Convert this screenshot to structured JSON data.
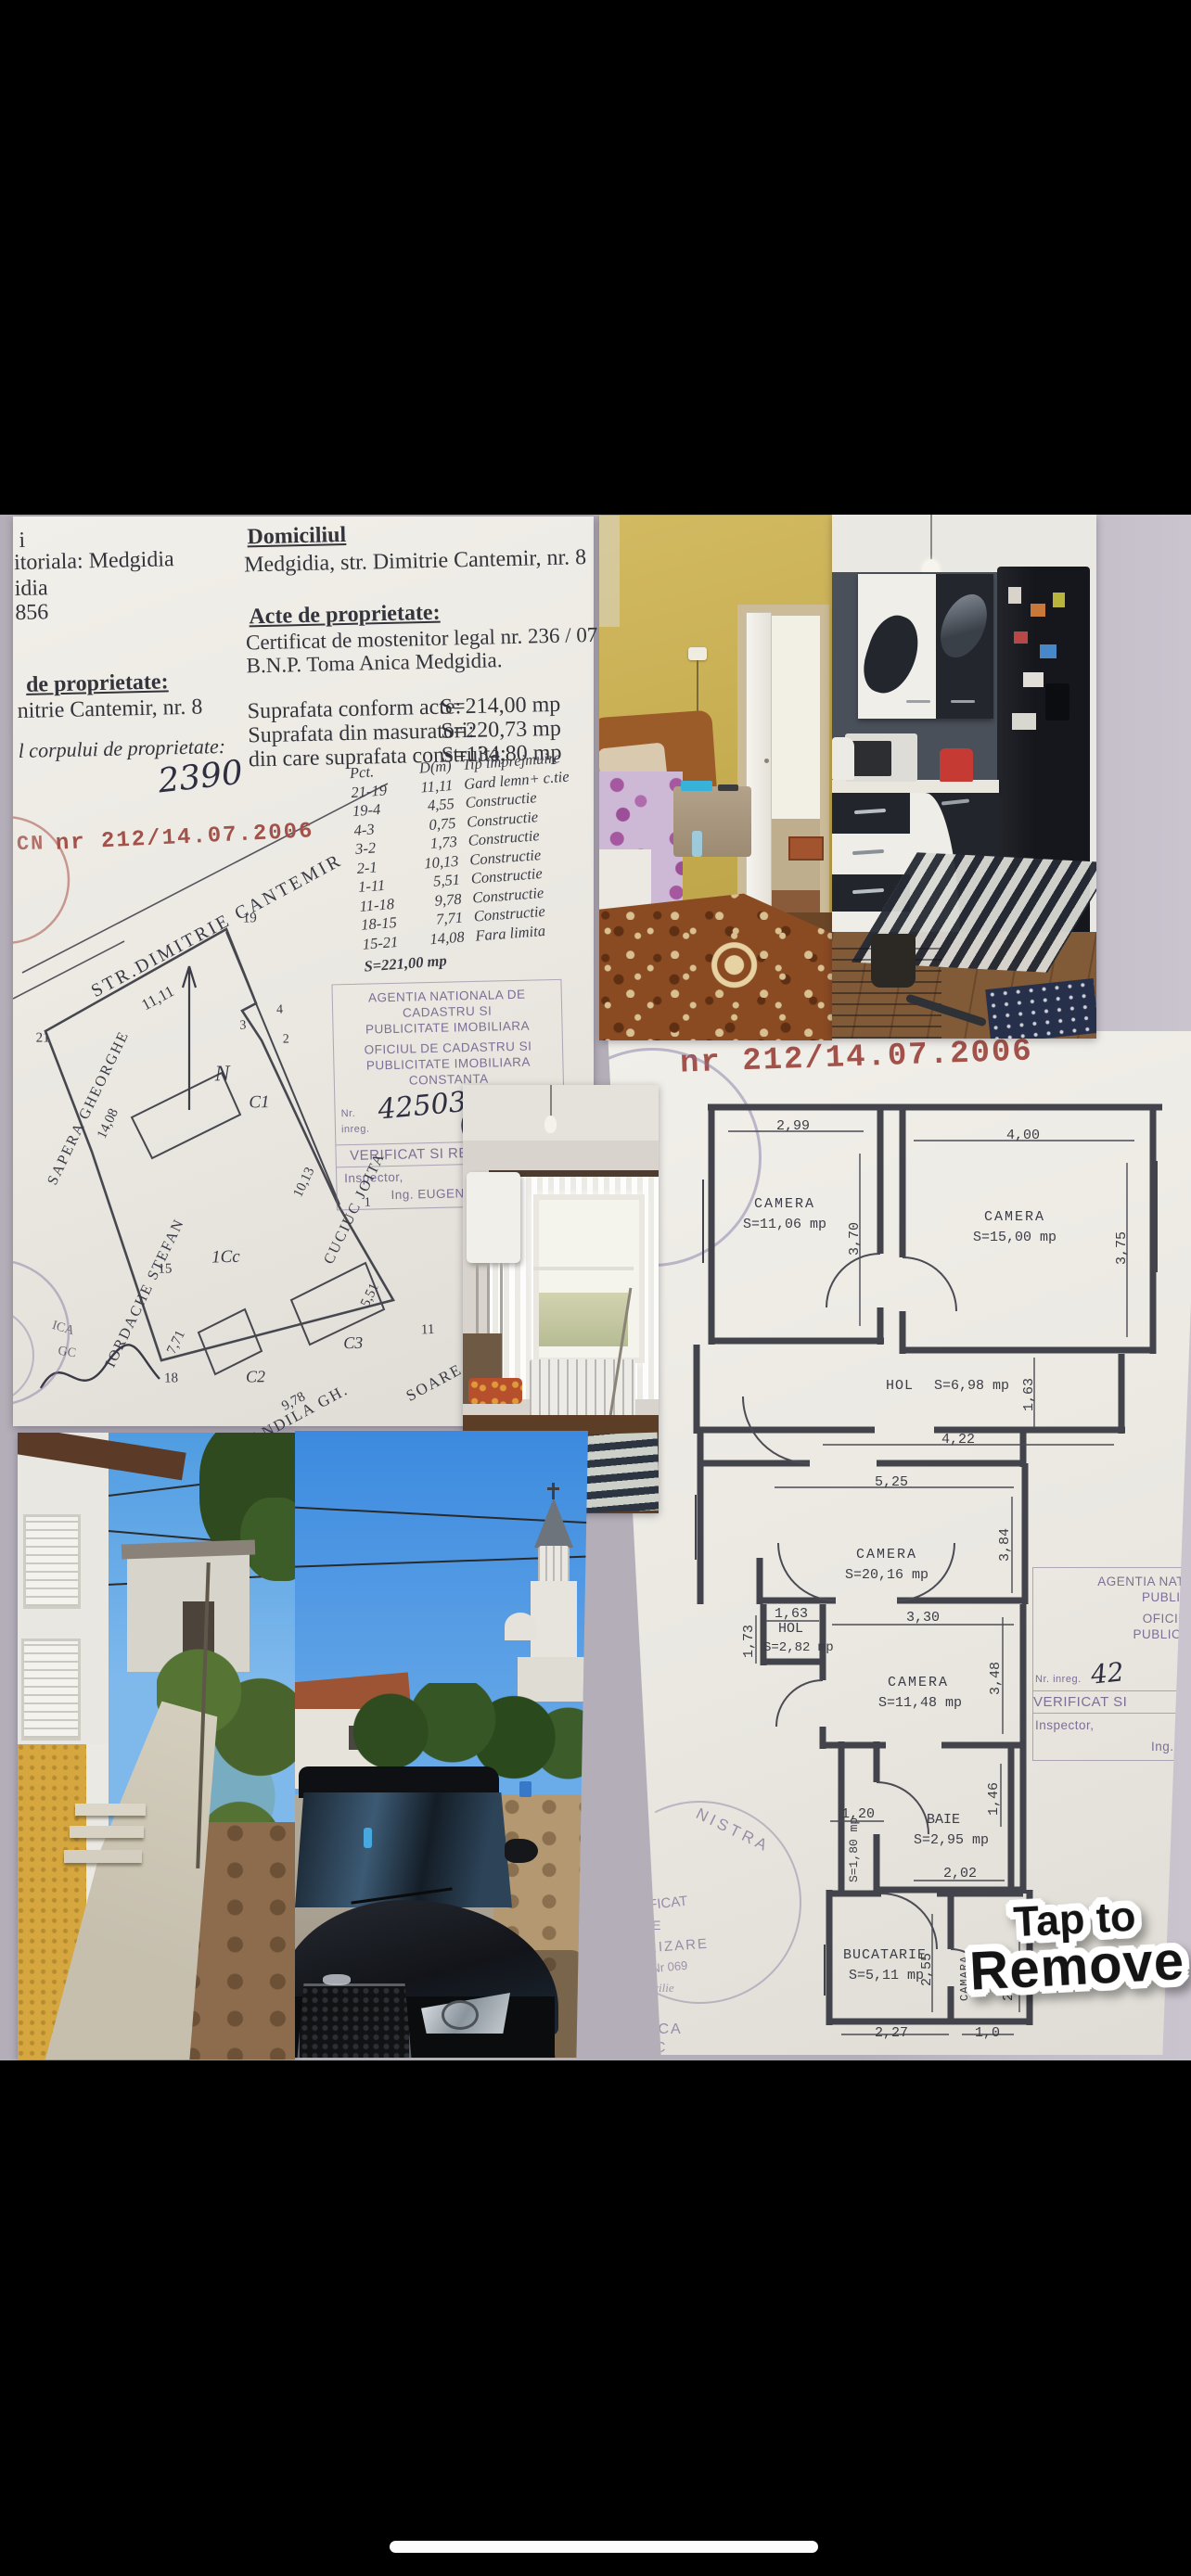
{
  "ui": {
    "tap_to_remove": {
      "line1": "Tap to",
      "line2": "Remove"
    }
  },
  "colors": {
    "letterbox": "#000000",
    "collage_background": "#b4aeb9",
    "paper": "#efede7",
    "stamp_red": "#a3524a",
    "stamp_purple": "#7d6f96"
  },
  "doc": {
    "frag": {
      "a": "i",
      "b": "itoriala: Medgidia",
      "c": "idia",
      "d": "856",
      "e": "de proprietate:",
      "f": "nitrie Cantemir, nr. 8",
      "g": "l corpului de proprietate:",
      "h": "2390"
    },
    "domicile_heading": "Domiciliul",
    "domicile_line": "Medgidia, str. Dimitrie Cantemir, nr. 8",
    "acts_heading": "Acte de proprietate:",
    "acts_line1": "Certificat de mostenitor legal nr. 236 / 07.09.2001",
    "acts_line2": "B.N.P. Toma Anica Medgidia.",
    "areas": [
      {
        "label": "Suprafata conform acte:",
        "value": "S=214,00 mp"
      },
      {
        "label": "Suprafata din masuratori:",
        "value": "S=220,73 mp"
      },
      {
        "label": "din care suprafata construita:",
        "value": "S=134,80 mp"
      }
    ],
    "stamp_prefix": "CN",
    "stamp_number": "nr 212/14.07.2006",
    "fence_table": {
      "h1": "Pct.",
      "h2": "Pct.",
      "h3": "D(m)",
      "h4": "Tip imprejmuire",
      "rows": [
        {
          "p": "21-19",
          "d": "11,11",
          "t": "Gard lemn+ c.tie"
        },
        {
          "p": "19-4",
          "d": "4,55",
          "t": "Constructie"
        },
        {
          "p": "4-3",
          "d": "0,75",
          "t": "Constructie"
        },
        {
          "p": "3-2",
          "d": "1,73",
          "t": "Constructie"
        },
        {
          "p": "2-1",
          "d": "10,13",
          "t": "Constructie"
        },
        {
          "p": "1-11",
          "d": "5,51",
          "t": "Constructie"
        },
        {
          "p": "11-18",
          "d": "9,78",
          "t": "Constructie"
        },
        {
          "p": "18-15",
          "d": "7,71",
          "t": "Constructie"
        },
        {
          "p": "15-21",
          "d": "14,08",
          "t": "Fara limita"
        }
      ],
      "total": "S=221,00 mp"
    },
    "cadastre_stamp": {
      "l1": "AGENTIA NATIONALA DE CADASTRU SI",
      "l2": "PUBLICITATE IMOBILIARA",
      "l3": "OFICIUL DE CADASTRU SI",
      "l4": "PUBLICITATE IMOBILIARA",
      "l5": "CONSTANTA",
      "reg_label": "Nr. inreg.",
      "reg_no": "42503",
      "date_label": "data",
      "reg_date": "2/XI 2006",
      "verified": "VERIFICAT SI RECEPTIONAT",
      "inspector_label": "Inspector,",
      "inspector_name": "Ing. EUGENIA PARASCHIV"
    },
    "edge_stamp": {
      "a": "ICA",
      "b": "GC"
    },
    "site_plan": {
      "north": "N",
      "street": "STR.DIMITRIE CANTEMIR",
      "street_dim": "11,11",
      "c1": "C1",
      "icc": "1Cc",
      "c2": "C2",
      "c3": "C3",
      "n_sapera": "SAPERA GHEORGHE",
      "n_iordache": "IORDACHE STEFAN",
      "n_cuciuc": "CUCIUC JOITA",
      "n_mandila": "MANDILA GH.",
      "n_soare": "SOARE GH.",
      "d_1408": "14,08",
      "d_771": "7,71",
      "d_1013": "10,13",
      "d_551": "5,51",
      "d_978": "9,78",
      "p21": "21",
      "p19": "19",
      "p18": "18",
      "p15": "15",
      "p11": "11",
      "p1": "1",
      "p2": "2",
      "p3": "3",
      "p4": "4"
    }
  },
  "plan": {
    "stamp_number": "nr 212/14.07.2006",
    "rooms": {
      "cam1": {
        "name": "CAMERA",
        "area": "S=11,06 mp",
        "w": "2,99",
        "h": "3,70"
      },
      "cam2": {
        "name": "CAMERA",
        "area": "S=15,00 mp",
        "w": "4,00",
        "h": "3,75"
      },
      "hol1": {
        "name": "HOL",
        "area": "S=6,98 mp",
        "w": "4,22",
        "h": "1,63"
      },
      "cam3": {
        "name": "CAMERA",
        "area": "S=20,16 mp",
        "w": "5,25",
        "h": "3,84"
      },
      "hol2": {
        "name": "HOL",
        "area": "S=2,82 mp",
        "w": "1,63",
        "h": "1,73"
      },
      "cam4": {
        "name": "CAMERA",
        "area": "S=11,48 mp",
        "w": "3,30",
        "h": "3,48"
      },
      "baie": {
        "name": "BAIE",
        "area": "S=2,95 mp",
        "w": "2,02",
        "h": "1,46"
      },
      "hol3": {
        "name": "HOL",
        "area": "S=1,80 mp"
      },
      "buc": {
        "name": "BUCATARIE",
        "area": "S=5,11 mp",
        "w": "2,27",
        "h": "2,55"
      },
      "camara": {
        "name": "CAMARA",
        "area": "S=2,65 mp",
        "w": "1,0",
        "h": "2,60"
      }
    },
    "dim_120": "1,20",
    "corner_stamp": {
      "l1": "AGENTIA NATIONA",
      "l2": "PUBLICITAT",
      "l3": "OFICIUL DE",
      "l4": "PUBLICITATE",
      "l5": "CONS",
      "reg_label": "Nr. inreg.",
      "reg_no": "42",
      "verified": "VERIFICAT SI",
      "inspector_label": "Inspector,",
      "inspector_name": "Ing. EUGE"
    },
    "round_stamp": {
      "arc": "NISTRA",
      "l1": "IFICAT",
      "l2": "DE",
      "l3": "RIZARE",
      "l4": "T Nr 069",
      "l5": "rilie",
      "l6": "A",
      "l7": "ICA",
      "l8": "3C"
    }
  }
}
